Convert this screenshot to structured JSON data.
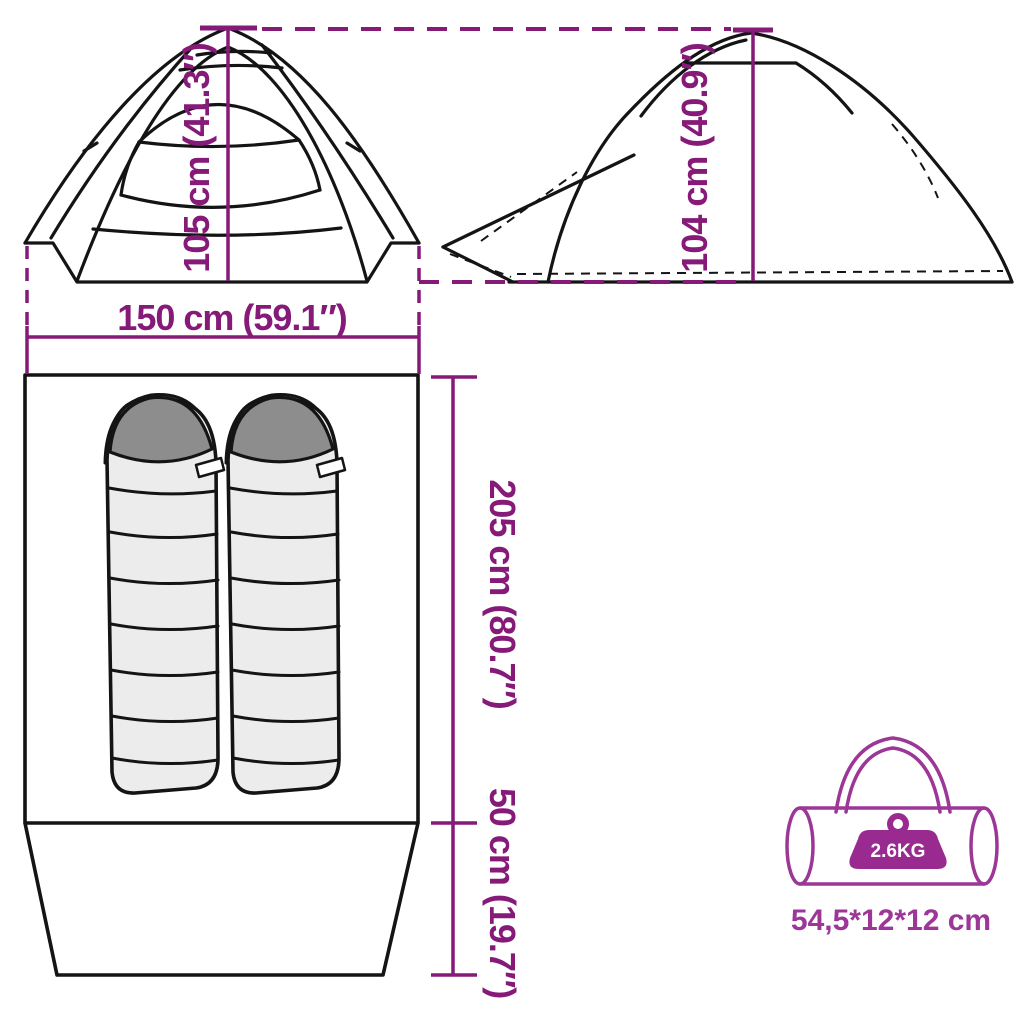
{
  "colors": {
    "dimension": "#851a78",
    "bag": "#9c3697",
    "weight_badge": "#992b90",
    "line": "#141414",
    "bag_fill": "#ececec",
    "hood_fill": "#8d8d8d"
  },
  "views": {
    "front": {
      "height_label": "105 cm (41.3″)",
      "width_label": "150 cm (59.1″)"
    },
    "side": {
      "height_label": "104 cm (40.9″)"
    },
    "floorplan": {
      "length_label": "205 cm (80.7″)",
      "vestibule_label": "50 cm (19.7″)",
      "sleeping_bag_count": 2
    },
    "packed": {
      "weight_label": "2.6KG",
      "dimensions_label": "54,5*12*12 cm"
    }
  }
}
